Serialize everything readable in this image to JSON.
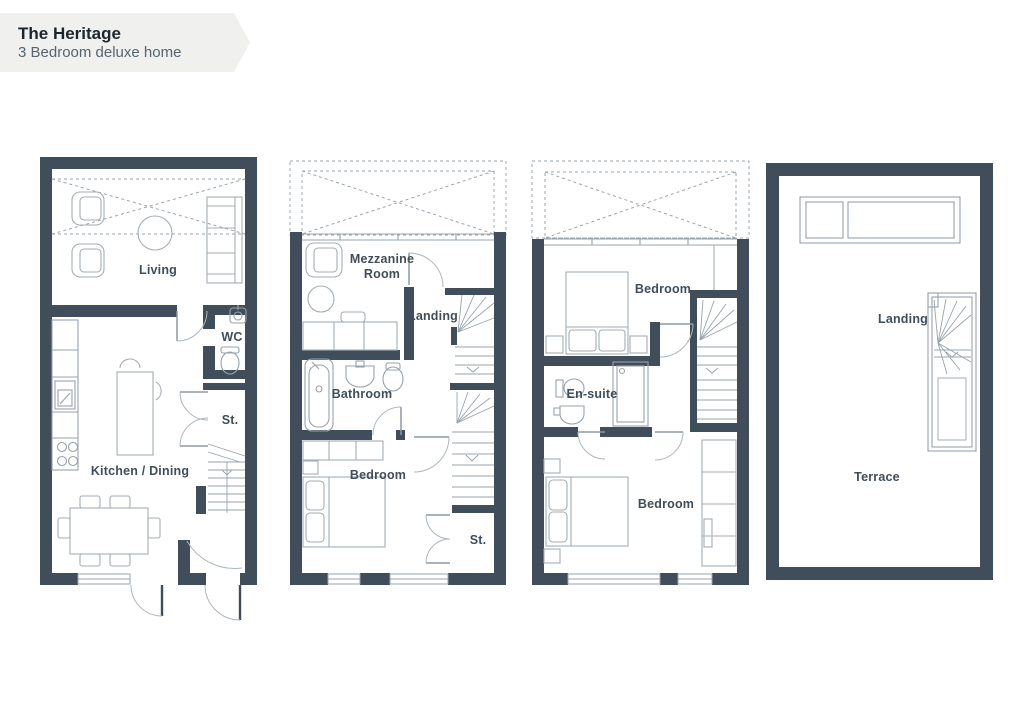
{
  "header": {
    "title": "The Heritage",
    "subtitle": "3 Bedroom deluxe home"
  },
  "floors": [
    {
      "id": "floor-plan-1",
      "rooms": {
        "living": "Living",
        "wc": "WC",
        "store": "St.",
        "kitchen_dining": "Kitchen / Dining"
      }
    },
    {
      "id": "floor-plan-2",
      "rooms": {
        "mezzanine_line1": "Mezzanine",
        "mezzanine_line2": "Room",
        "landing": "Landing",
        "bathroom": "Bathroom",
        "bedroom": "Bedroom",
        "store": "St."
      }
    },
    {
      "id": "floor-plan-3",
      "rooms": {
        "bedroom_front": "Bedroom",
        "ensuite": "En-suite",
        "bedroom_back": "Bedroom"
      }
    },
    {
      "id": "floor-plan-4",
      "rooms": {
        "landing": "Landing",
        "terrace": "Terrace"
      }
    }
  ],
  "colors": {
    "wall": "#3F4E5A",
    "furniture_line": "#A4AEB6",
    "fixture_line": "#98A3AC",
    "dashed_line": "#9AA5AE",
    "label_text": "#3F4E5A",
    "banner_background": "#F0F0EE",
    "title_text": "#1B262E",
    "subtitle_text": "#566570",
    "page_background": "#FFFFFF"
  }
}
